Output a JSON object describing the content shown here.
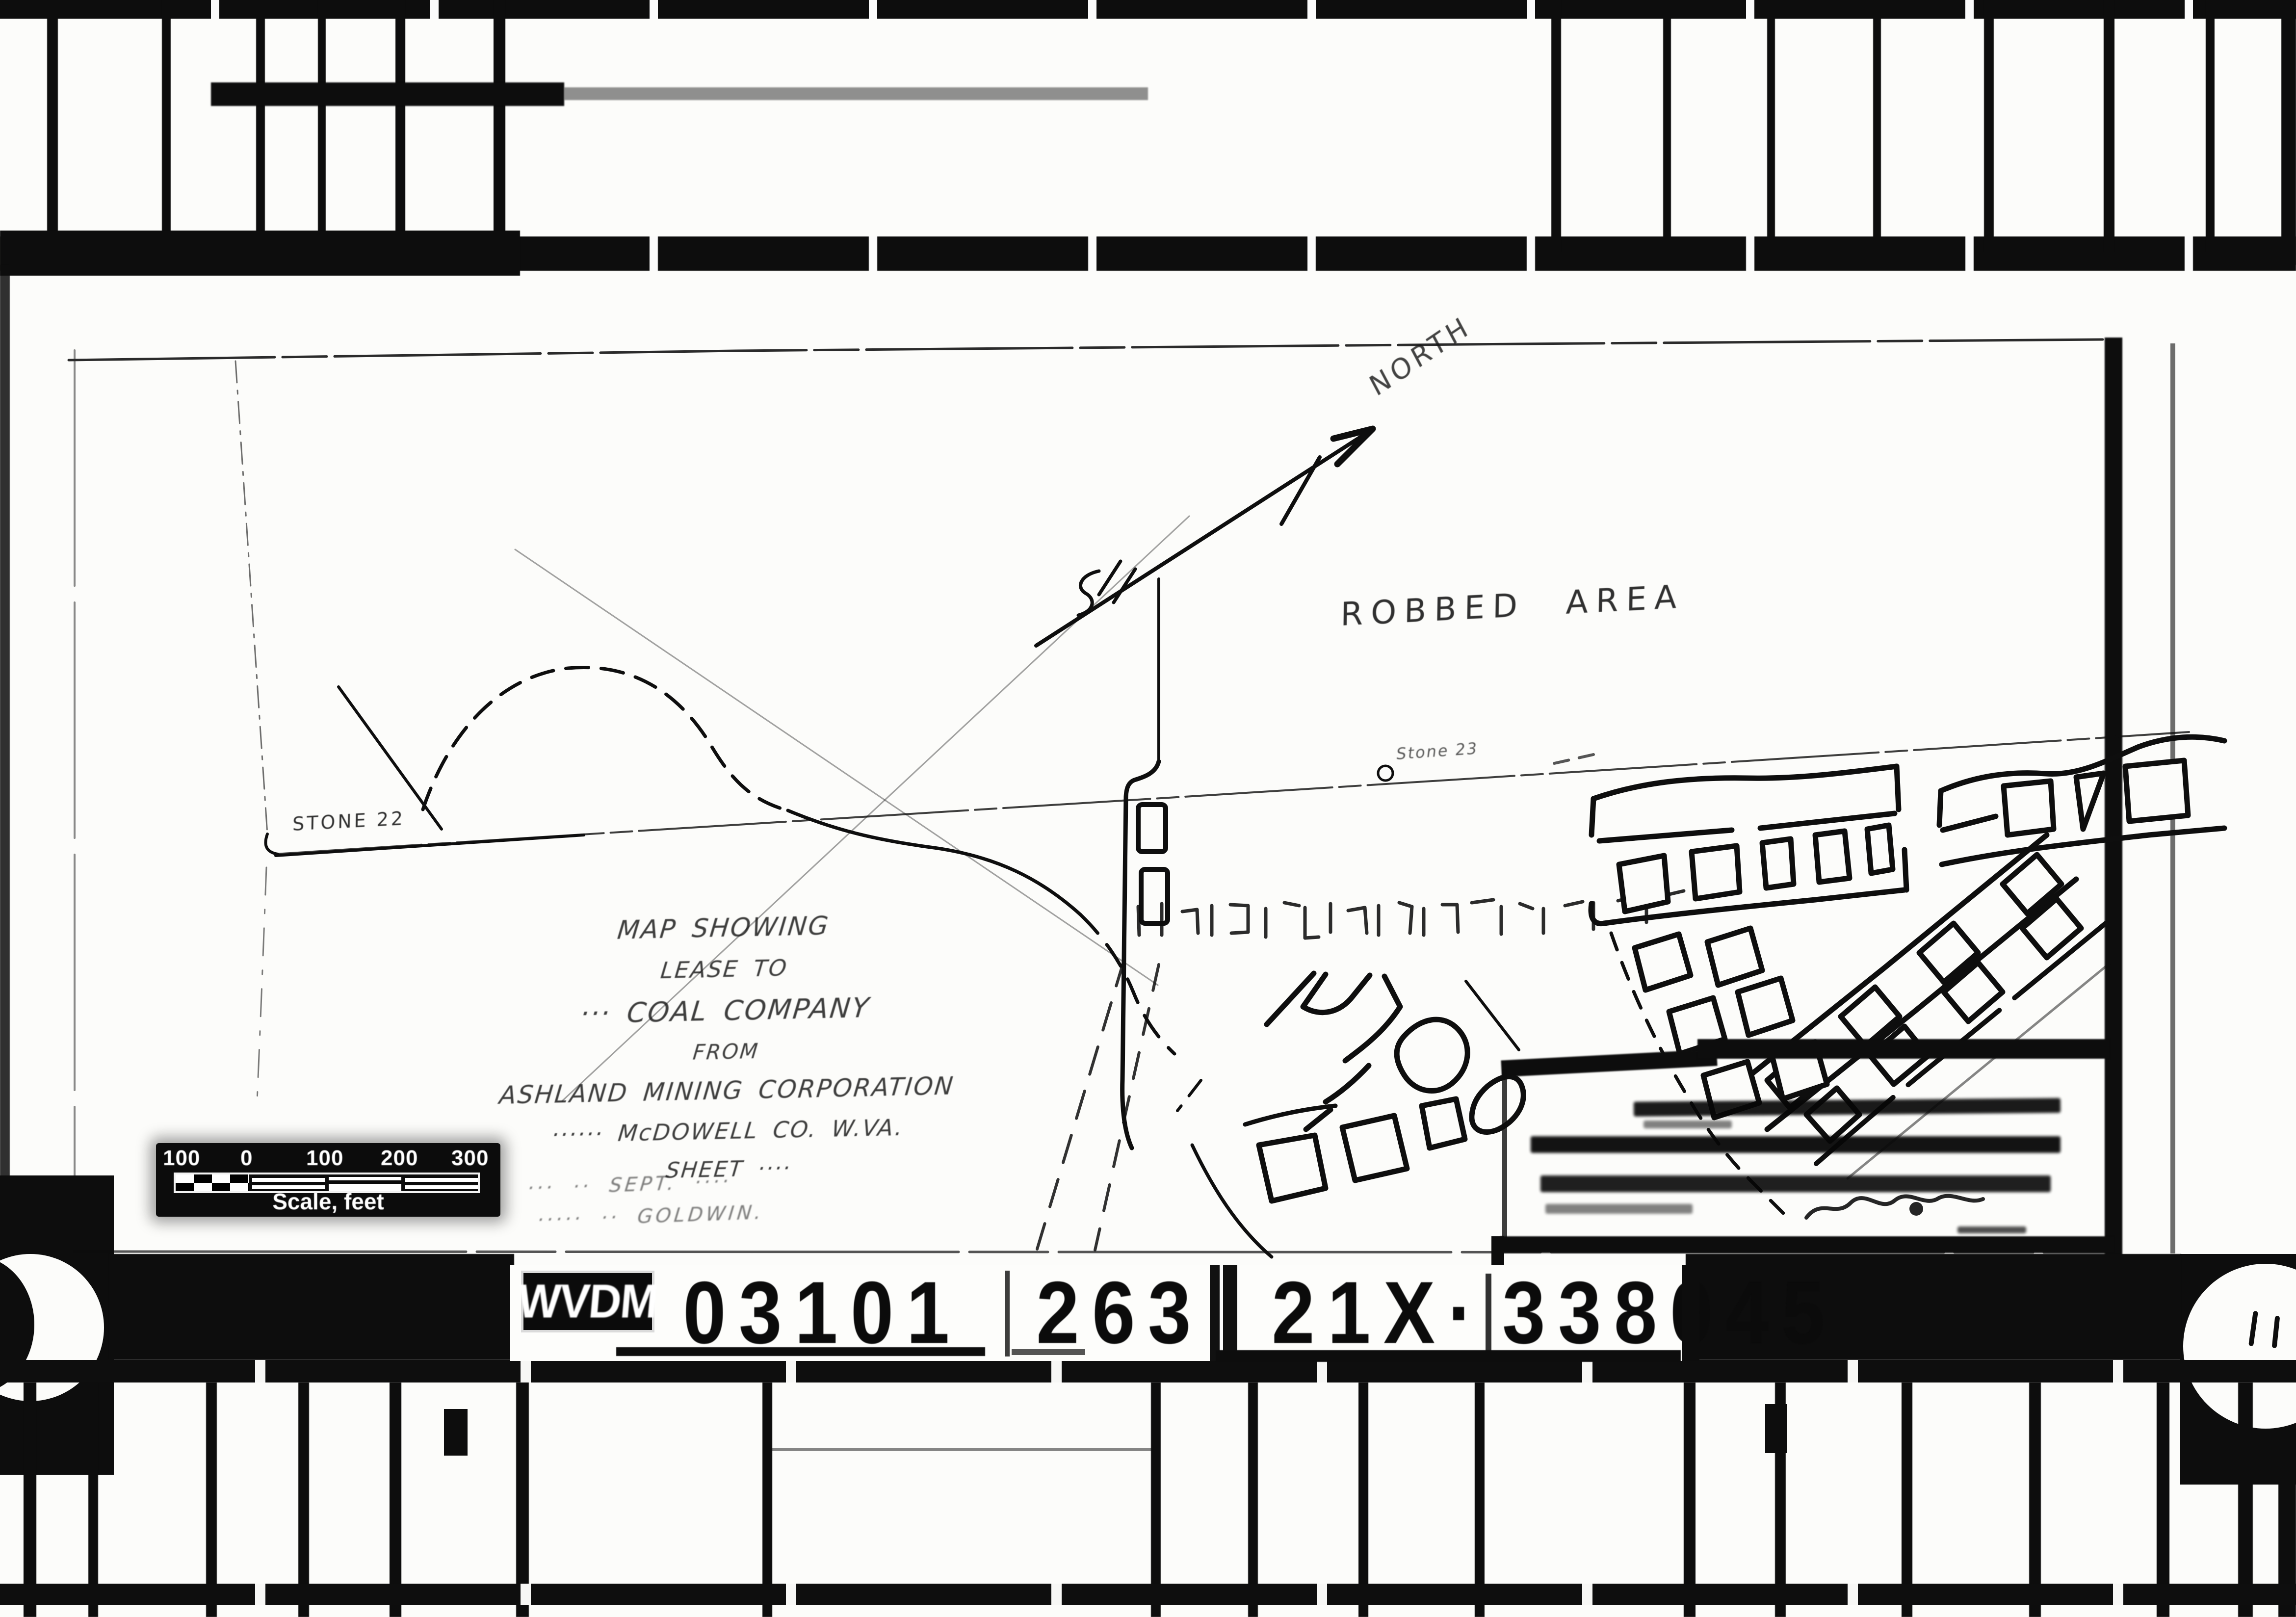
{
  "microfilm": {
    "id_strip": {
      "agency_code": "WVDM",
      "frame_numbers": [
        "03101",
        "263",
        "21X·",
        "338045"
      ]
    }
  },
  "map": {
    "compass_label": "NORTH",
    "annotations": {
      "robbed_area": "ROBBED AREA",
      "stone_22": "STONE 22",
      "stone_23": "Stone 23"
    },
    "title_block": {
      "lines": [
        "MAP SHOWING",
        "LEASE TO",
        "··· COAL COMPANY",
        "FROM",
        "ASHLAND MINING CORPORATION",
        "······ McDOWELL CO. W.VA.",
        "SHEET ····"
      ],
      "notes": [
        "··· ·· SEPT. ····",
        "····· ·· GOLDWIN."
      ]
    },
    "scale_bar": {
      "tick_labels": [
        "100",
        "0",
        "100",
        "200",
        "300"
      ],
      "caption": "Scale, feet"
    },
    "certification_box": {
      "text_legible": false,
      "illegible_text_lines": 4,
      "signature_present": true
    }
  }
}
